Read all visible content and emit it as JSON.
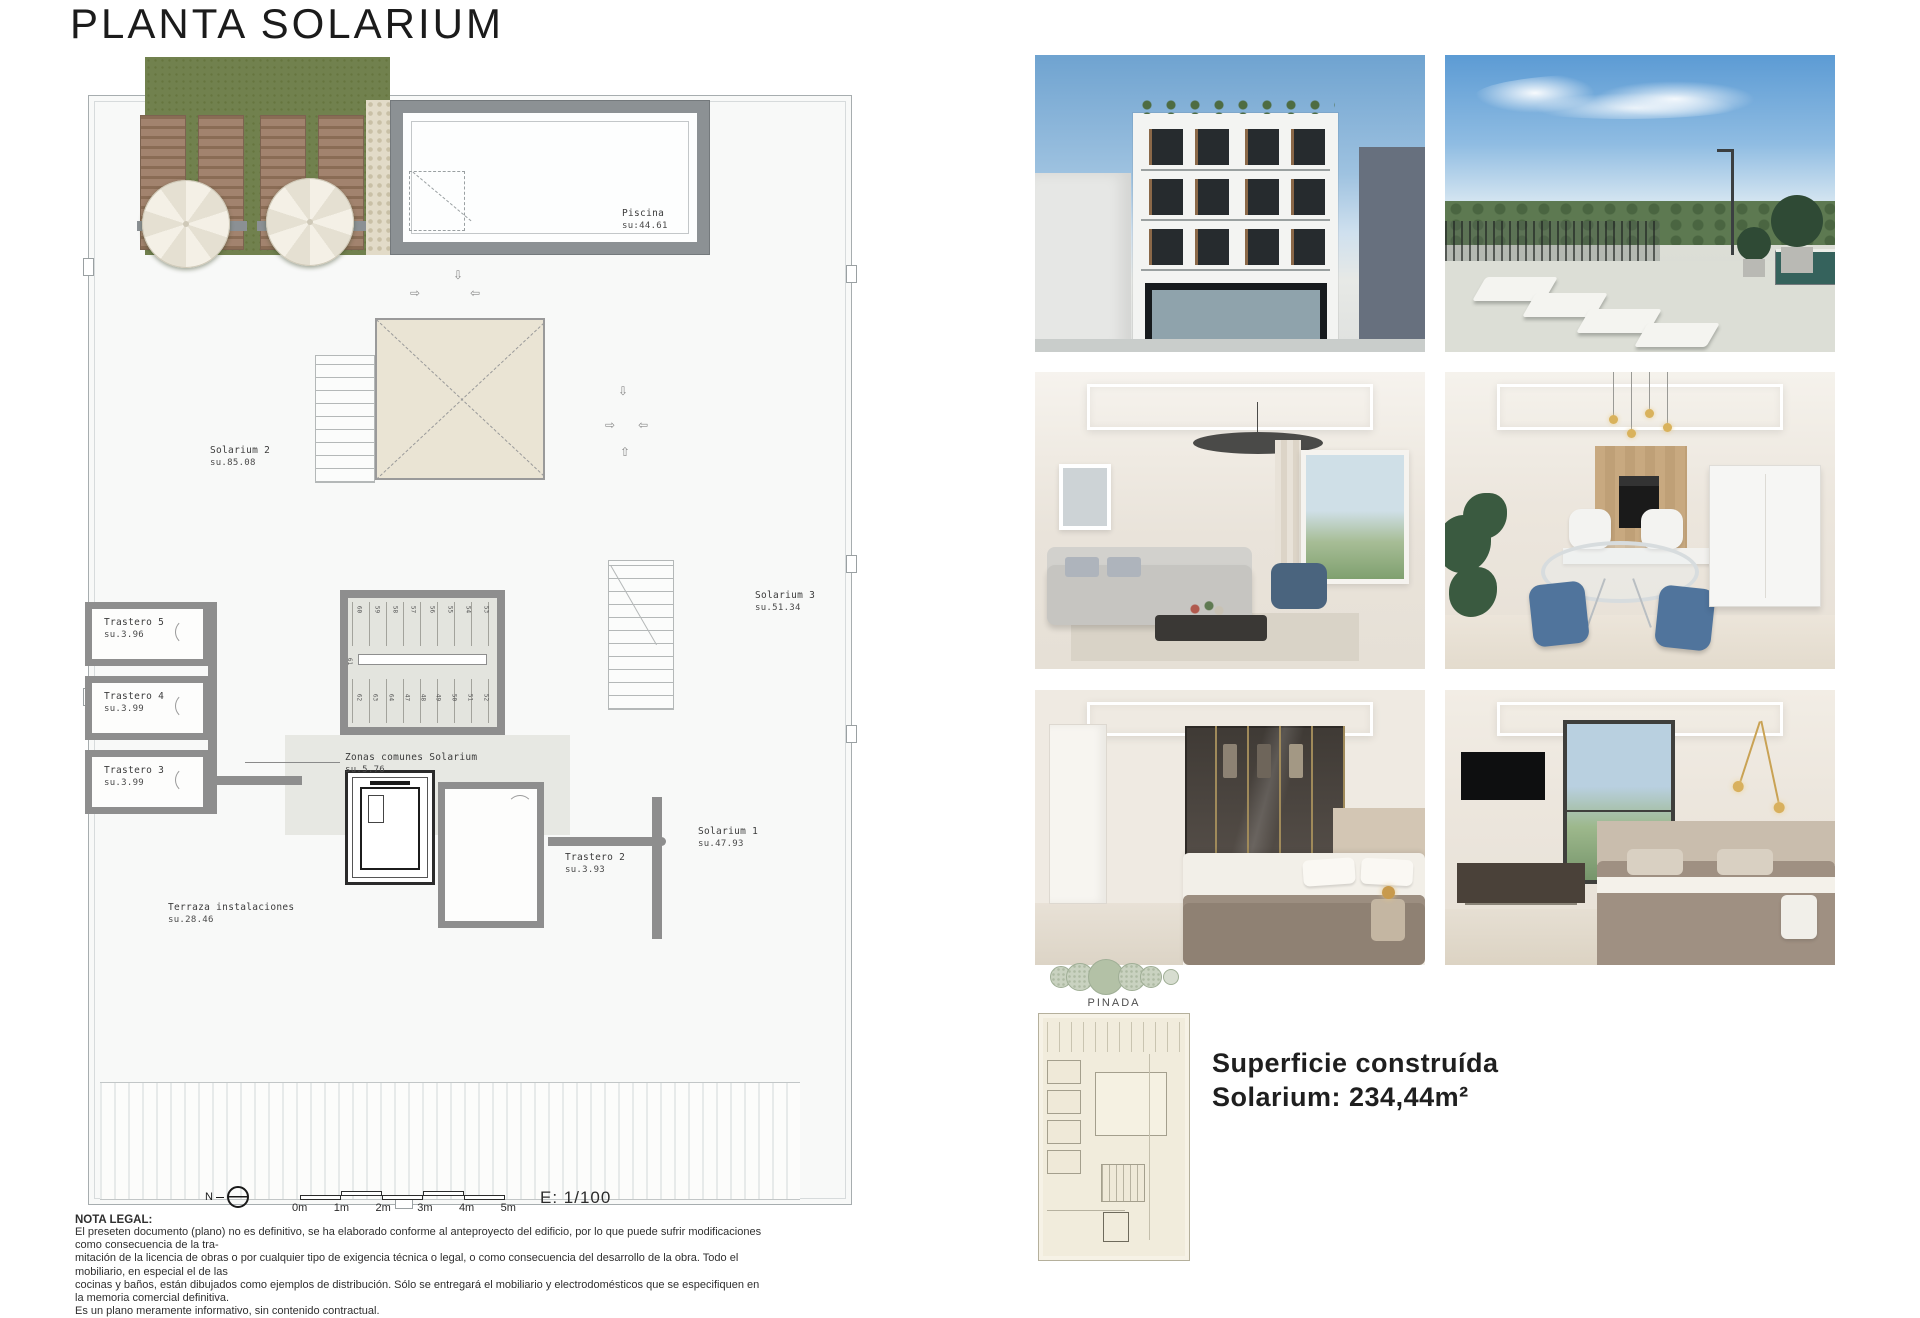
{
  "title": "PLANTA SOLARIUM",
  "plan": {
    "rooms": {
      "piscina": {
        "name": "Piscina",
        "area": "SU:44.61"
      },
      "solarium2": {
        "name": "Solarium 2",
        "area": "SU.85.08"
      },
      "solarium3": {
        "name": "Solarium 3",
        "area": "SU.51.34"
      },
      "solarium1": {
        "name": "Solarium 1",
        "area": "SU.47.93"
      },
      "trastero5": {
        "name": "Trastero 5",
        "area": "SU.3.96"
      },
      "trastero4": {
        "name": "Trastero 4",
        "area": "SU.3.99"
      },
      "trastero3": {
        "name": "Trastero 3",
        "area": "SU.3.99"
      },
      "trastero2": {
        "name": "Trastero 2",
        "area": "SU.3.93"
      },
      "zonas": {
        "name": "Zonas comunes Solarium",
        "area": "SU.5.76"
      },
      "terraza": {
        "name": "Terraza instalaciones",
        "area": "SU.28.46"
      }
    },
    "stairs": {
      "top_row": [
        "60",
        "59",
        "58",
        "57",
        "56",
        "55",
        "54",
        "53"
      ],
      "mid": "61",
      "bottom_row": [
        "62",
        "63",
        "64",
        "47",
        "48",
        "49",
        "50",
        "51",
        "52"
      ]
    },
    "compass": "N",
    "scale_ticks": [
      "0m",
      "1m",
      "2m",
      "3m",
      "4m",
      "5m"
    ],
    "scale_ratio": "E: 1/100"
  },
  "legal": {
    "heading": "NOTA LEGAL:",
    "lines": [
      "El preseten documento (plano) no es definitivo, se ha elaborado conforme al anteproyecto del edificio, por lo que puede sufrir modificaciones como consecuencia de la tra-",
      "mitación de la licencia de obras o por cualquier tipo de exigencia técnica o legal, o como consecuencia del desarrollo de la obra. Todo el mobiliario, en especial el de las",
      "cocinas y baños, están dibujados como ejemplos de distribución. Sólo se entregará el mobiliario y electrodomésticos que se especifiquen en la memoria comercial definitiva.",
      "Es un plano meramente informativo, sin contenido contractual."
    ]
  },
  "summary": {
    "site_label": "PINADA",
    "line1": "Superficie construída",
    "line2": "Solarium: 234,44m²"
  },
  "colors": {
    "grass": "#71814e",
    "wall_grey": "#8e8e8e",
    "skylight_beige": "#eae4d4"
  }
}
